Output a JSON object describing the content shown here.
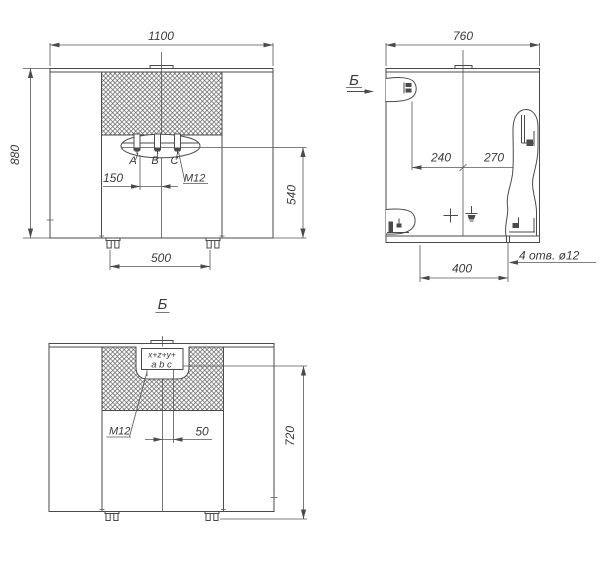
{
  "drawing": {
    "background": "#ffffff",
    "line_color": "#4a4a4a",
    "text_color": "#3a3a3a",
    "front_view": {
      "dim_width": "1100",
      "dim_height": "880",
      "dim_terminal_pitch": "150",
      "dim_terminal_height": "540",
      "dim_feet_span": "500",
      "terminal_labels": {
        "a": "A",
        "b": "B",
        "c": "C"
      },
      "thread_note": "M12"
    },
    "side_view": {
      "dim_width": "760",
      "view_arrow_label": "Б",
      "dim_left_offset": "240",
      "dim_right_offset": "270",
      "dim_holes_span": "400",
      "holes_note": "4 отв. ø12"
    },
    "rear_view": {
      "view_label": "Б",
      "thread_note": "M12",
      "dim_offset": "50",
      "dim_height": "720",
      "terminal_marking_top": "x+z+y+",
      "terminal_marking_bottom": "a b c"
    }
  }
}
